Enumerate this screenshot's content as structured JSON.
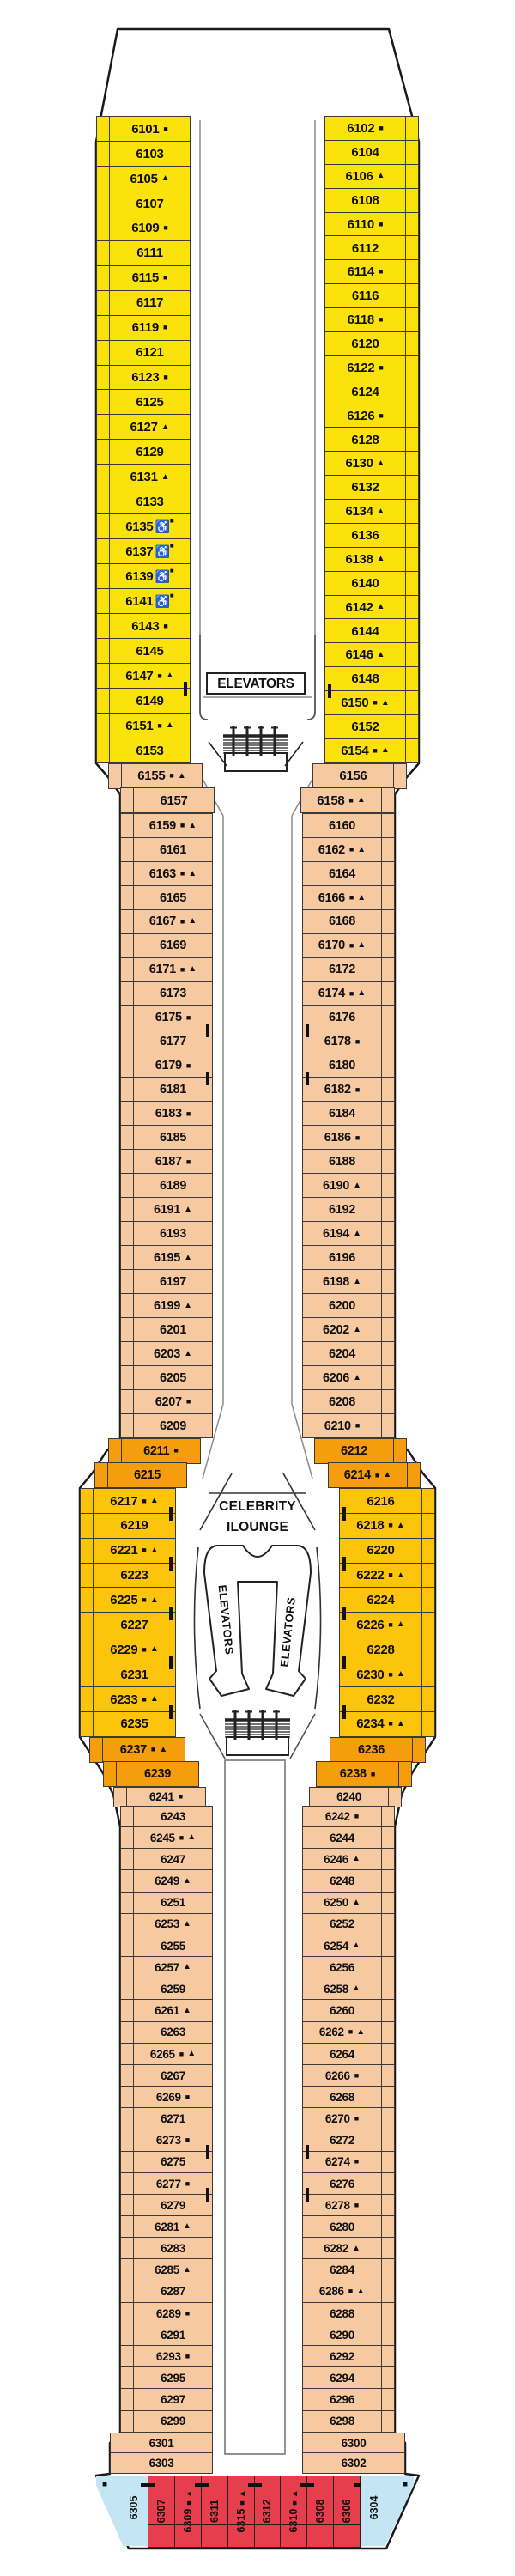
{
  "labels": {
    "elevators": "ELEVATORS",
    "lounge_line1": "CELEBRITY",
    "lounge_line2": "ILOUNGE"
  },
  "symbol_glyphs": {
    "sq": "■",
    "tri": "▲",
    "wc": "♿"
  },
  "colors": {
    "yellow": "#FCE20B",
    "gold": "#FCC40B",
    "orange": "#F59D0C",
    "peach": "#F7C9A1",
    "red": "#E63E4D",
    "blue": "#C4E5F4"
  },
  "deck": {
    "left_sections": [
      {
        "id": "forward-port",
        "color": "yellow",
        "cabins": [
          {
            "n": "6101",
            "s": [
              "sq"
            ]
          },
          {
            "n": "6103"
          },
          {
            "n": "6105",
            "s": [
              "tri"
            ]
          },
          {
            "n": "6107"
          },
          {
            "n": "6109",
            "s": [
              "sq"
            ]
          },
          {
            "n": "6111"
          },
          {
            "n": "6115",
            "s": [
              "sq"
            ]
          },
          {
            "n": "6117"
          },
          {
            "n": "6119",
            "s": [
              "sq"
            ]
          },
          {
            "n": "6121"
          },
          {
            "n": "6123",
            "s": [
              "sq"
            ]
          },
          {
            "n": "6125"
          },
          {
            "n": "6127",
            "s": [
              "tri"
            ]
          },
          {
            "n": "6129"
          },
          {
            "n": "6131",
            "s": [
              "tri"
            ]
          },
          {
            "n": "6133"
          },
          {
            "n": "6135",
            "s": [
              "wc",
              "sq"
            ]
          },
          {
            "n": "6137",
            "s": [
              "wc",
              "sq"
            ]
          },
          {
            "n": "6139",
            "s": [
              "wc",
              "sq"
            ]
          },
          {
            "n": "6141",
            "s": [
              "wc",
              "sq"
            ]
          },
          {
            "n": "6143",
            "s": [
              "sq"
            ]
          },
          {
            "n": "6145"
          },
          {
            "n": "6147",
            "s": [
              "sq",
              "tri"
            ],
            "c": true
          },
          {
            "n": "6149"
          },
          {
            "n": "6151",
            "s": [
              "sq",
              "tri"
            ]
          },
          {
            "n": "6153"
          }
        ]
      },
      {
        "id": "transition-fwd-port",
        "color": "peach",
        "cabins": [
          {
            "n": "6155",
            "s": [
              "sq",
              "tri"
            ]
          },
          {
            "n": "6157"
          }
        ]
      },
      {
        "id": "midship-fwd-port",
        "color": "peach",
        "cabins": [
          {
            "n": "6159",
            "s": [
              "sq",
              "tri"
            ]
          },
          {
            "n": "6161"
          },
          {
            "n": "6163",
            "s": [
              "sq",
              "tri"
            ]
          },
          {
            "n": "6165"
          },
          {
            "n": "6167",
            "s": [
              "sq",
              "tri"
            ]
          },
          {
            "n": "6169"
          },
          {
            "n": "6171",
            "s": [
              "sq",
              "tri"
            ]
          },
          {
            "n": "6173"
          },
          {
            "n": "6175",
            "s": [
              "sq"
            ],
            "c": true
          },
          {
            "n": "6177"
          },
          {
            "n": "6179",
            "s": [
              "sq"
            ],
            "c": true
          },
          {
            "n": "6181"
          },
          {
            "n": "6183",
            "s": [
              "sq"
            ]
          },
          {
            "n": "6185"
          },
          {
            "n": "6187",
            "s": [
              "sq"
            ]
          },
          {
            "n": "6189"
          },
          {
            "n": "6191",
            "s": [
              "tri"
            ]
          },
          {
            "n": "6193"
          },
          {
            "n": "6195",
            "s": [
              "tri"
            ]
          },
          {
            "n": "6197"
          },
          {
            "n": "6199",
            "s": [
              "tri"
            ]
          },
          {
            "n": "6201"
          },
          {
            "n": "6203",
            "s": [
              "tri"
            ]
          },
          {
            "n": "6205"
          },
          {
            "n": "6207",
            "s": [
              "sq"
            ]
          },
          {
            "n": "6209"
          }
        ]
      },
      {
        "id": "lounge-fwd-port",
        "color": "orange",
        "cabins": [
          {
            "n": "6211",
            "s": [
              "sq"
            ]
          },
          {
            "n": "6215"
          }
        ]
      },
      {
        "id": "lounge-port",
        "color": "gold",
        "cabins": [
          {
            "n": "6217",
            "s": [
              "sq",
              "tri"
            ],
            "c": true
          },
          {
            "n": "6219"
          },
          {
            "n": "6221",
            "s": [
              "sq",
              "tri"
            ],
            "c": true
          },
          {
            "n": "6223"
          },
          {
            "n": "6225",
            "s": [
              "sq",
              "tri"
            ],
            "c": true
          },
          {
            "n": "6227"
          },
          {
            "n": "6229",
            "s": [
              "sq",
              "tri"
            ],
            "c": true
          },
          {
            "n": "6231"
          },
          {
            "n": "6233",
            "s": [
              "sq",
              "tri"
            ],
            "c": true
          },
          {
            "n": "6235"
          }
        ]
      },
      {
        "id": "lounge-aft-port",
        "color": "orange",
        "cabins": [
          {
            "n": "6237",
            "s": [
              "sq",
              "tri"
            ]
          },
          {
            "n": "6239"
          }
        ]
      },
      {
        "id": "transition-aft-port",
        "color": "peach",
        "cabins": [
          {
            "n": "6241",
            "s": [
              "sq"
            ]
          },
          {
            "n": "6243"
          }
        ]
      },
      {
        "id": "aft-port",
        "color": "peach",
        "cabins": [
          {
            "n": "6245",
            "s": [
              "sq",
              "tri"
            ]
          },
          {
            "n": "6247"
          },
          {
            "n": "6249",
            "s": [
              "tri"
            ]
          },
          {
            "n": "6251"
          },
          {
            "n": "6253",
            "s": [
              "tri"
            ]
          },
          {
            "n": "6255"
          },
          {
            "n": "6257",
            "s": [
              "tri"
            ]
          },
          {
            "n": "6259"
          },
          {
            "n": "6261",
            "s": [
              "tri"
            ]
          },
          {
            "n": "6263"
          },
          {
            "n": "6265",
            "s": [
              "sq",
              "tri"
            ]
          },
          {
            "n": "6267"
          },
          {
            "n": "6269",
            "s": [
              "sq"
            ]
          },
          {
            "n": "6271"
          },
          {
            "n": "6273",
            "s": [
              "sq"
            ],
            "c": true
          },
          {
            "n": "6275"
          },
          {
            "n": "6277",
            "s": [
              "sq"
            ],
            "c": true
          },
          {
            "n": "6279"
          },
          {
            "n": "6281",
            "s": [
              "tri"
            ]
          },
          {
            "n": "6283"
          },
          {
            "n": "6285",
            "s": [
              "tri"
            ]
          },
          {
            "n": "6287"
          },
          {
            "n": "6289",
            "s": [
              "sq"
            ]
          },
          {
            "n": "6291"
          },
          {
            "n": "6293",
            "s": [
              "sq"
            ]
          },
          {
            "n": "6295"
          },
          {
            "n": "6297"
          },
          {
            "n": "6299"
          }
        ]
      },
      {
        "id": "stern-taper-port",
        "color": "peach",
        "cabins": [
          {
            "n": "6301"
          },
          {
            "n": "6303"
          }
        ]
      }
    ],
    "right_sections": [
      {
        "id": "forward-stbd",
        "color": "yellow",
        "cabins": [
          {
            "n": "6102",
            "s": [
              "sq"
            ]
          },
          {
            "n": "6104"
          },
          {
            "n": "6106",
            "s": [
              "tri"
            ]
          },
          {
            "n": "6108"
          },
          {
            "n": "6110",
            "s": [
              "sq"
            ]
          },
          {
            "n": "6112"
          },
          {
            "n": "6114",
            "s": [
              "sq"
            ]
          },
          {
            "n": "6116"
          },
          {
            "n": "6118",
            "s": [
              "sq"
            ]
          },
          {
            "n": "6120"
          },
          {
            "n": "6122",
            "s": [
              "sq"
            ]
          },
          {
            "n": "6124"
          },
          {
            "n": "6126",
            "s": [
              "sq"
            ]
          },
          {
            "n": "6128"
          },
          {
            "n": "6130",
            "s": [
              "tri"
            ]
          },
          {
            "n": "6132"
          },
          {
            "n": "6134",
            "s": [
              "tri"
            ]
          },
          {
            "n": "6136"
          },
          {
            "n": "6138",
            "s": [
              "tri"
            ]
          },
          {
            "n": "6140"
          },
          {
            "n": "6142",
            "s": [
              "tri"
            ]
          },
          {
            "n": "6144"
          },
          {
            "n": "6146",
            "s": [
              "tri"
            ]
          },
          {
            "n": "6148",
            "c": true
          },
          {
            "n": "6150",
            "s": [
              "sq",
              "tri"
            ]
          },
          {
            "n": "6152"
          },
          {
            "n": "6154",
            "s": [
              "sq",
              "tri"
            ]
          }
        ]
      },
      {
        "id": "transition-fwd-stbd",
        "color": "peach",
        "cabins": [
          {
            "n": "6156"
          },
          {
            "n": "6158",
            "s": [
              "sq",
              "tri"
            ]
          }
        ]
      },
      {
        "id": "midship-fwd-stbd",
        "color": "peach",
        "cabins": [
          {
            "n": "6160"
          },
          {
            "n": "6162",
            "s": [
              "sq",
              "tri"
            ]
          },
          {
            "n": "6164"
          },
          {
            "n": "6166",
            "s": [
              "sq",
              "tri"
            ]
          },
          {
            "n": "6168"
          },
          {
            "n": "6170",
            "s": [
              "sq",
              "tri"
            ]
          },
          {
            "n": "6172"
          },
          {
            "n": "6174",
            "s": [
              "sq",
              "tri"
            ]
          },
          {
            "n": "6176",
            "c": true
          },
          {
            "n": "6178",
            "s": [
              "sq"
            ]
          },
          {
            "n": "6180",
            "c": true
          },
          {
            "n": "6182",
            "s": [
              "sq"
            ]
          },
          {
            "n": "6184"
          },
          {
            "n": "6186",
            "s": [
              "sq"
            ]
          },
          {
            "n": "6188"
          },
          {
            "n": "6190",
            "s": [
              "tri"
            ]
          },
          {
            "n": "6192"
          },
          {
            "n": "6194",
            "s": [
              "tri"
            ]
          },
          {
            "n": "6196"
          },
          {
            "n": "6198",
            "s": [
              "tri"
            ]
          },
          {
            "n": "6200"
          },
          {
            "n": "6202",
            "s": [
              "tri"
            ]
          },
          {
            "n": "6204"
          },
          {
            "n": "6206",
            "s": [
              "tri"
            ]
          },
          {
            "n": "6208"
          },
          {
            "n": "6210",
            "s": [
              "sq"
            ]
          }
        ]
      },
      {
        "id": "lounge-fwd-stbd",
        "color": "orange",
        "cabins": [
          {
            "n": "6212"
          },
          {
            "n": "6214",
            "s": [
              "sq",
              "tri"
            ]
          }
        ]
      },
      {
        "id": "lounge-stbd",
        "color": "gold",
        "cabins": [
          {
            "n": "6216",
            "c": true
          },
          {
            "n": "6218",
            "s": [
              "sq",
              "tri"
            ]
          },
          {
            "n": "6220",
            "c": true
          },
          {
            "n": "6222",
            "s": [
              "sq",
              "tri"
            ]
          },
          {
            "n": "6224",
            "c": true
          },
          {
            "n": "6226",
            "s": [
              "sq",
              "tri"
            ]
          },
          {
            "n": "6228",
            "c": true
          },
          {
            "n": "6230",
            "s": [
              "sq",
              "tri"
            ]
          },
          {
            "n": "6232",
            "c": true
          },
          {
            "n": "6234",
            "s": [
              "sq",
              "tri"
            ]
          }
        ]
      },
      {
        "id": "lounge-aft-stbd",
        "color": "orange",
        "cabins": [
          {
            "n": "6236"
          },
          {
            "n": "6238",
            "s": [
              "sq"
            ]
          }
        ]
      },
      {
        "id": "transition-aft-stbd",
        "color": "peach",
        "cabins": [
          {
            "n": "6240"
          },
          {
            "n": "6242",
            "s": [
              "sq"
            ]
          }
        ]
      },
      {
        "id": "aft-stbd",
        "color": "peach",
        "cabins": [
          {
            "n": "6244"
          },
          {
            "n": "6246",
            "s": [
              "tri"
            ]
          },
          {
            "n": "6248"
          },
          {
            "n": "6250",
            "s": [
              "tri"
            ]
          },
          {
            "n": "6252"
          },
          {
            "n": "6254",
            "s": [
              "tri"
            ]
          },
          {
            "n": "6256"
          },
          {
            "n": "6258",
            "s": [
              "tri"
            ]
          },
          {
            "n": "6260"
          },
          {
            "n": "6262",
            "s": [
              "sq",
              "tri"
            ]
          },
          {
            "n": "6264"
          },
          {
            "n": "6266",
            "s": [
              "sq"
            ]
          },
          {
            "n": "6268"
          },
          {
            "n": "6270",
            "s": [
              "sq"
            ]
          },
          {
            "n": "6272",
            "c": true
          },
          {
            "n": "6274",
            "s": [
              "sq"
            ]
          },
          {
            "n": "6276",
            "c": true
          },
          {
            "n": "6278",
            "s": [
              "sq"
            ]
          },
          {
            "n": "6280"
          },
          {
            "n": "6282",
            "s": [
              "tri"
            ]
          },
          {
            "n": "6284"
          },
          {
            "n": "6286",
            "s": [
              "sq",
              "tri"
            ]
          },
          {
            "n": "6288"
          },
          {
            "n": "6290"
          },
          {
            "n": "6292"
          },
          {
            "n": "6294"
          },
          {
            "n": "6296"
          },
          {
            "n": "6298"
          }
        ]
      },
      {
        "id": "stern-taper-stbd",
        "color": "peach",
        "cabins": [
          {
            "n": "6300"
          },
          {
            "n": "6302"
          }
        ]
      }
    ],
    "stern": {
      "port_corner": {
        "n": "6305",
        "s": [
          "sq"
        ]
      },
      "cabins": [
        {
          "n": "6307",
          "cl": true
        },
        {
          "n": "6309",
          "s": [
            "sq",
            "tri"
          ],
          "c": true
        },
        {
          "n": "6311"
        },
        {
          "n": "6315",
          "s": [
            "sq",
            "tri"
          ],
          "c": true
        },
        {
          "n": "6312"
        },
        {
          "n": "6310",
          "s": [
            "sq",
            "tri"
          ],
          "c": true
        },
        {
          "n": "6308"
        },
        {
          "n": "6306",
          "c": true
        }
      ],
      "stbd_corner": {
        "n": "6304",
        "s": [
          "sq"
        ]
      }
    }
  }
}
